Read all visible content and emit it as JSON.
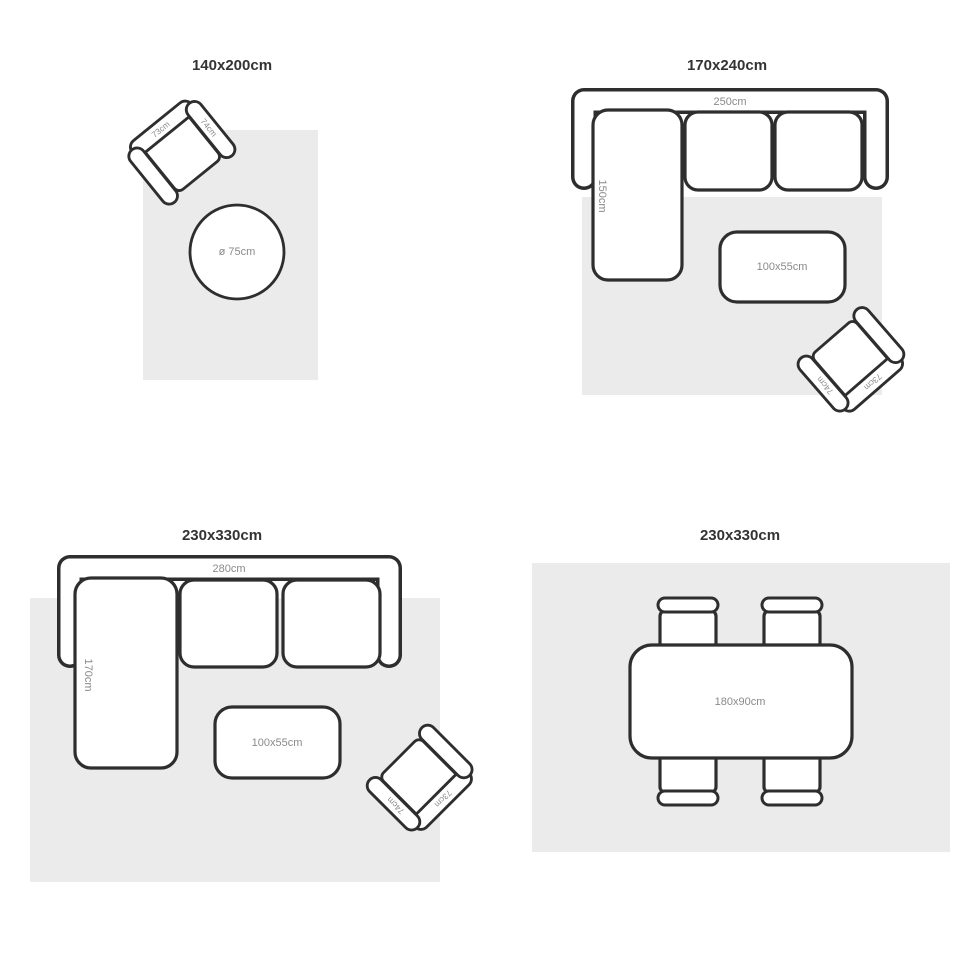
{
  "palette": {
    "background": "#ffffff",
    "line": "#2e2e2e",
    "rug_fill": "#ebebeb",
    "title_text": "#333333",
    "dimension_text": "#8a8a8a"
  },
  "quadrants": [
    {
      "title": "140x200cm",
      "round_table_label": "ø 75cm",
      "armchair": {
        "back_label": "73cm",
        "arm_label": "74cm"
      }
    },
    {
      "title": "170x240cm",
      "sofa": {
        "width_label": "250cm",
        "chaise_label": "150cm"
      },
      "coffee_table_label": "100x55cm",
      "armchair": {
        "back_label": "73cm",
        "arm_label": "74cm"
      }
    },
    {
      "title": "230x330cm",
      "sofa": {
        "width_label": "280cm",
        "chaise_label": "170cm"
      },
      "coffee_table_label": "100x55cm",
      "armchair": {
        "back_label": "73cm",
        "arm_label": "74cm"
      }
    },
    {
      "title": "230x330cm",
      "dining_table_label": "180x90cm"
    }
  ]
}
